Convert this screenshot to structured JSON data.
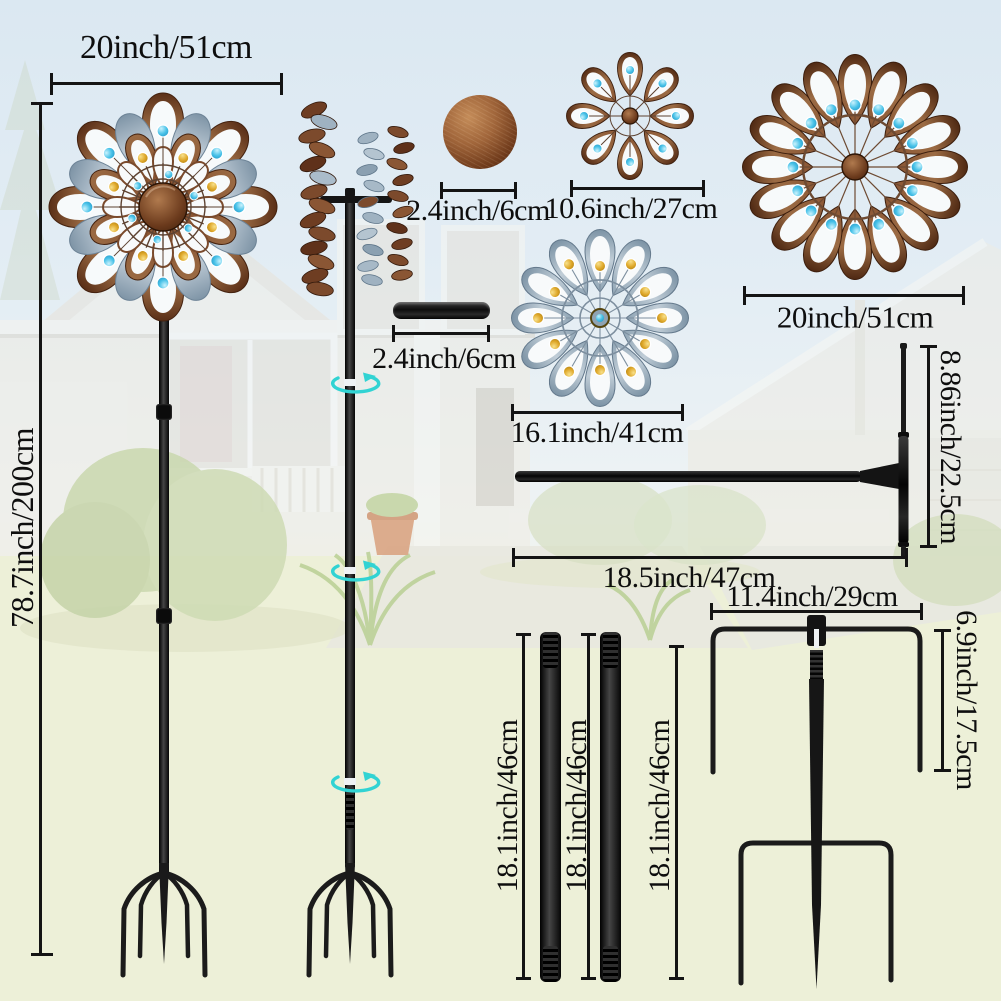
{
  "title": "Wind spinner parts dimension diagram",
  "dimensions": {
    "rotor_width": "20inch/51cm",
    "total_height": "78.7inch/200cm",
    "cap": "2.4inch/6cm",
    "small_rotor": "10.6inch/27cm",
    "large_rotor": "20inch/51cm",
    "connector": "2.4inch/6cm",
    "blue_rotor": "16.1inch/41cm",
    "crossbar_height": "8.86inch/22.5cm",
    "crossbar_length": "18.5inch/47cm",
    "stake_width": "11.4inch/29cm",
    "stake_prong": "6.9inch/17.5cm",
    "pole_a": "18.1inch/46cm",
    "pole_b": "18.1inch/46cm",
    "stake_spike": "18.1inch/46cm"
  },
  "icons": [
    "rotation-arrow-icon"
  ],
  "colors": {
    "copper": "#7c4a2d",
    "copper_light": "#a4714a",
    "blue_petal": "#a7b9c7",
    "gem_blue": "#35b5e2",
    "gem_amber": "#d9a41c",
    "metal_black": "#171717",
    "arrow_cyan": "#31d3d3",
    "dimension_ink": "#141414",
    "lawn": "#edf0d8",
    "sky": "#dbe8f2"
  }
}
